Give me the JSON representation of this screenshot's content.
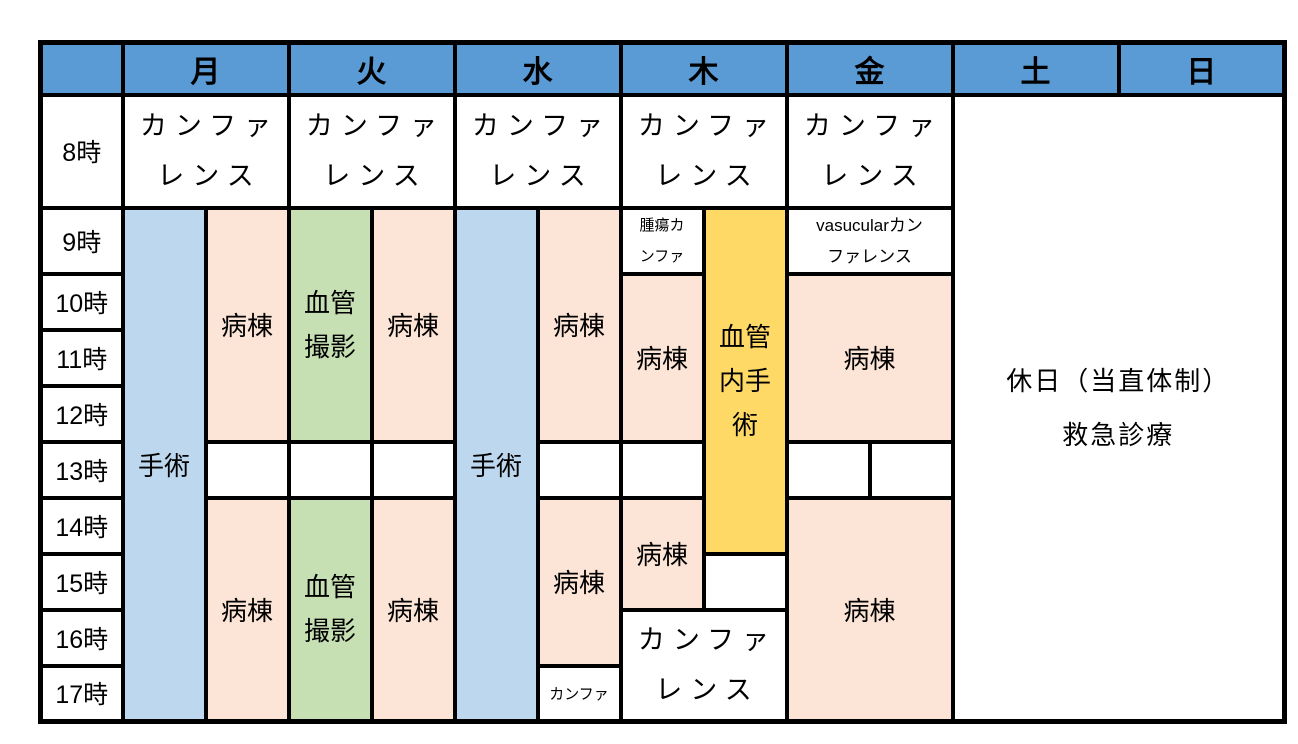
{
  "table": {
    "days": [
      "月",
      "火",
      "水",
      "木",
      "金",
      "土",
      "日"
    ],
    "times": [
      "8時",
      "9時",
      "10時",
      "11時",
      "12時",
      "13時",
      "14時",
      "15時",
      "16時",
      "17時"
    ],
    "colors": {
      "header": "#5B9BD5",
      "surgery": "#BDD7EE",
      "ward": "#FCE4D6",
      "angiography": "#C6E0B4",
      "endovascular": "#FFD966",
      "break": "#FFFFFF",
      "border": "#000000"
    },
    "blocks": {
      "mon_conference": {
        "lines": [
          "カンファ",
          "レンス"
        ]
      },
      "tue_conference": {
        "lines": [
          "カンファ",
          "レンス"
        ]
      },
      "wed_conference": {
        "lines": [
          "カンファ",
          "レンス"
        ]
      },
      "thu_conference": {
        "lines": [
          "カンファ",
          "レンス"
        ]
      },
      "fri_conference": {
        "lines": [
          "カンファ",
          "レンス"
        ]
      },
      "mon_surgery": {
        "label": "手術"
      },
      "mon_ward_am": {
        "label": "病棟"
      },
      "mon_ward_pm": {
        "label": "病棟"
      },
      "tue_angiography_am": {
        "lines": [
          "血管",
          "撮影"
        ]
      },
      "tue_ward_am": {
        "label": "病棟"
      },
      "tue_angiography_pm": {
        "lines": [
          "血管",
          "撮影"
        ]
      },
      "tue_ward_pm": {
        "label": "病棟"
      },
      "wed_surgery": {
        "label": "手術"
      },
      "wed_ward_am": {
        "label": "病棟"
      },
      "wed_ward_pm": {
        "label": "病棟"
      },
      "wed_evening_conference": {
        "label": "カンファ"
      },
      "thu_tumor_conference": {
        "lines": [
          "腫瘍カ",
          "ンファ"
        ]
      },
      "thu_endovascular_surgery": {
        "lines": [
          "血管",
          "内手",
          "術"
        ]
      },
      "thu_ward_am": {
        "label": "病棟"
      },
      "thu_ward_pm": {
        "label": "病棟"
      },
      "thu_evening_conference": {
        "lines": [
          "カンファ",
          "レンス"
        ]
      },
      "fri_vascular_conference": {
        "lines": [
          "vasucularカン",
          "ファレンス"
        ]
      },
      "fri_ward_am": {
        "label": "病棟"
      },
      "fri_ward_pm": {
        "label": "病棟"
      },
      "weekend": {
        "lines": [
          "休日（当直体制）",
          "救急診療"
        ]
      }
    }
  }
}
